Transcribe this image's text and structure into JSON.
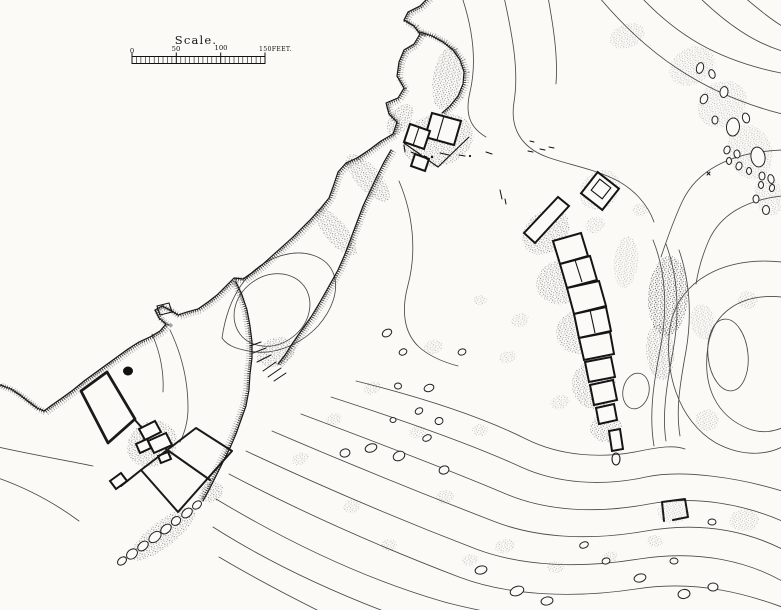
{
  "scale_bar": {
    "title": "Scale.",
    "ticks": [
      "0",
      "50",
      "100",
      "150FEET."
    ],
    "minor_divisions": 30,
    "major_interval_feet": 50,
    "total_feet": 150
  },
  "colors": {
    "paper": "#fbfaf7",
    "ink": "#161616",
    "contour": "#4a4a48",
    "stipple": "#2e2e2e"
  },
  "features": [
    "coastline-with-cliff-hachures",
    "tidal-inlet-and-gully",
    "topographic-contours",
    "ruined-building-chain",
    "hut-cluster-north",
    "double-walled-hut",
    "long-hall-ruin",
    "farmstead-with-field-walls",
    "rocky-point",
    "scattered-boulders",
    "oval-hollow-with-pond",
    "small-square-enclosure",
    "stippled-scree-patches"
  ]
}
